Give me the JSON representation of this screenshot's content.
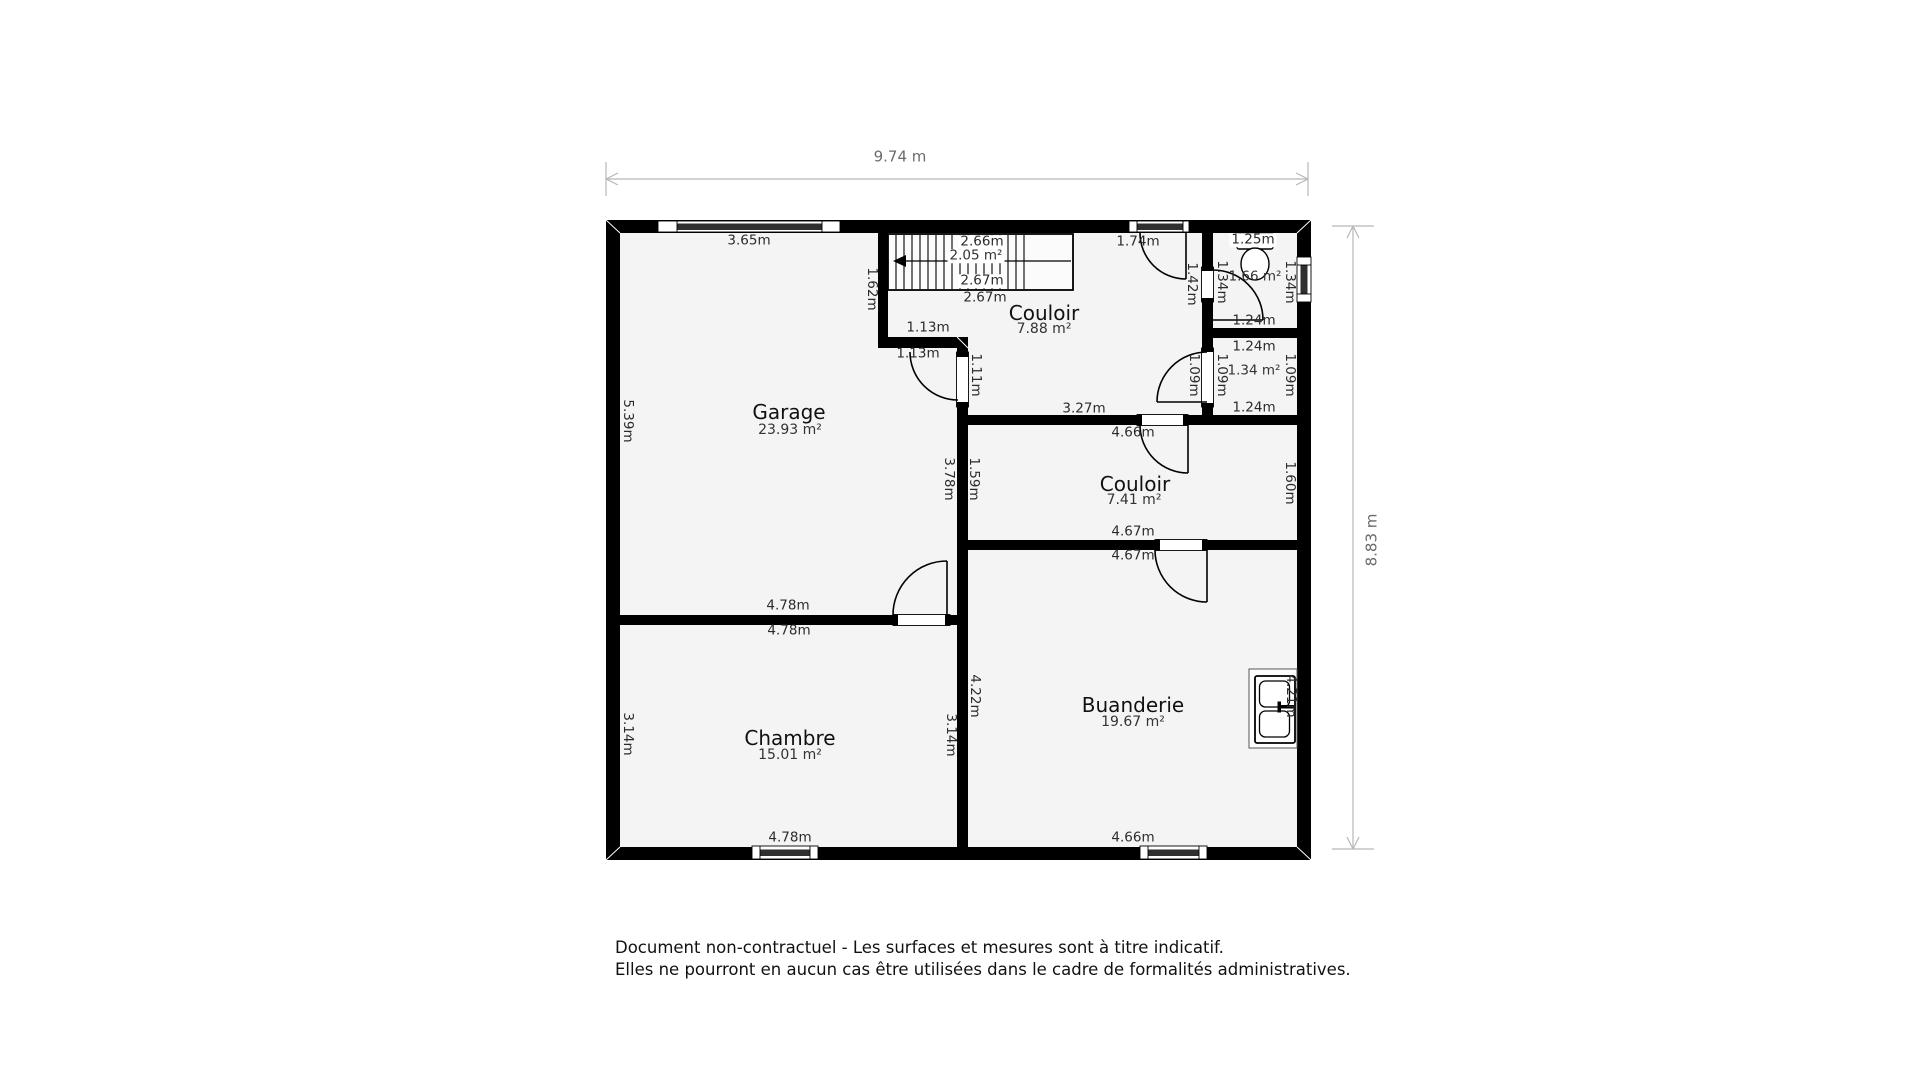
{
  "plan": {
    "dimensions": {
      "width_label": "9.74 m",
      "height_label": "8.83 m"
    },
    "rooms": [
      {
        "name": "Garage",
        "area": "23.93 m²"
      },
      {
        "name": "Couloir",
        "area": "7.88 m²"
      },
      {
        "name": "Couloir",
        "area": "7.41 m²"
      },
      {
        "name": "Chambre",
        "area": "15.01 m²"
      },
      {
        "name": "Buanderie",
        "area": "19.67 m²"
      },
      {
        "area": "2.05 m²"
      },
      {
        "area": "1.66 m²"
      },
      {
        "area": "1.34 m²"
      }
    ],
    "measurements": [
      {
        "t": "3.65m"
      },
      {
        "t": "1.74m"
      },
      {
        "t": "1.25m"
      },
      {
        "t": "1.42m"
      },
      {
        "t": "1.34m"
      },
      {
        "t": "1.34m"
      },
      {
        "t": "1.24m"
      },
      {
        "t": "2.66m"
      },
      {
        "t": "2.67m"
      },
      {
        "t": "2.67m"
      },
      {
        "t": "1.62m"
      },
      {
        "t": "1.24m"
      },
      {
        "t": "1.09m"
      },
      {
        "t": "1.09m"
      },
      {
        "t": "1.09m"
      },
      {
        "t": "1.24m"
      },
      {
        "t": "1.13m"
      },
      {
        "t": "1.13m"
      },
      {
        "t": "1.11m"
      },
      {
        "t": "3.27m"
      },
      {
        "t": "4.66m"
      },
      {
        "t": "5.39m"
      },
      {
        "t": "3.78m"
      },
      {
        "t": "1.59m"
      },
      {
        "t": "1.60m"
      },
      {
        "t": "4.67m"
      },
      {
        "t": "4.67m"
      },
      {
        "t": "4.78m"
      },
      {
        "t": "4.78m"
      },
      {
        "t": "4.22m"
      },
      {
        "t": "4.21m"
      },
      {
        "t": "3.14m"
      },
      {
        "t": "3.14m"
      },
      {
        "t": "4.78m"
      },
      {
        "t": "4.66m"
      }
    ],
    "icons": {
      "toilet": "toilet-icon",
      "appliance": "washer-sink-icon",
      "stairs_direction": "arrow-left-icon"
    }
  },
  "footer": {
    "line1": "Document non-contractuel - Les surfaces et mesures sont à titre indicatif.",
    "line2": "Elles ne pourront en aucun cas être utilisées dans le cadre de formalités administratives."
  },
  "colors": {
    "wall": "#000000",
    "floor": "#f4f4f4",
    "dimension_line": "#b8b8b8",
    "dimension_text": "#6b6b6b",
    "label_text": "#2b2b2b"
  }
}
